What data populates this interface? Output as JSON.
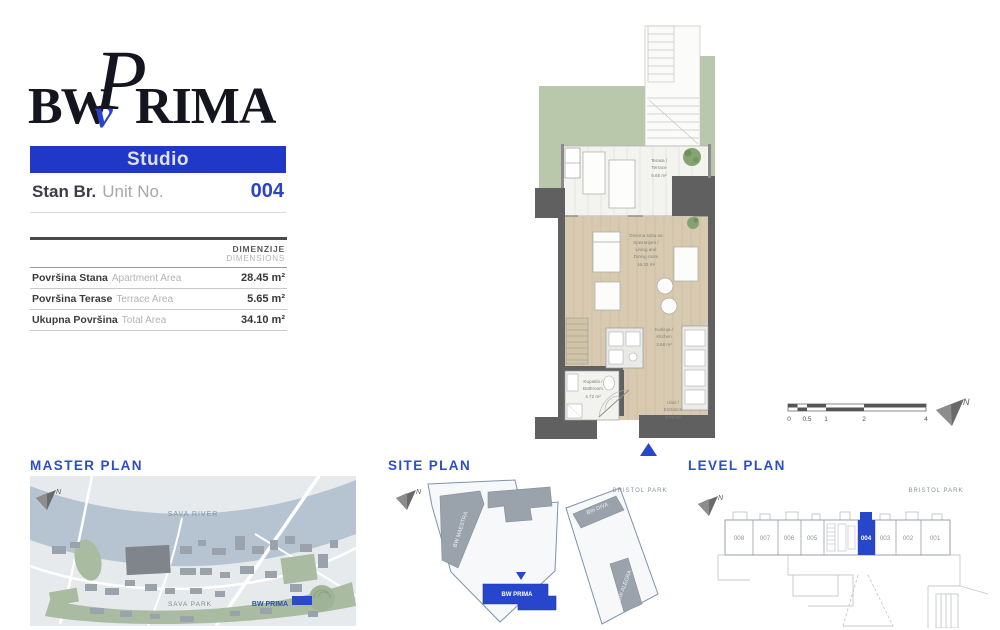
{
  "colors": {
    "accent_blue": "#2b43c8",
    "banner_blue": "#2038c8",
    "wall_gray": "#606060",
    "floor_wood": "#d8cab0",
    "lawn_green": "#b9c7ab",
    "river_blue": "#b6c3d1",
    "park_green": "#a9bca1",
    "building_gray": "#9aa2ab"
  },
  "logo": {
    "bw": "BW",
    "v": "v",
    "p": "P",
    "rima": "RIMA"
  },
  "unit_card": {
    "type_label": "Studio",
    "stan_br": "Stan Br.",
    "unit_no": "Unit No.",
    "unit_number": "004"
  },
  "dimensions_table": {
    "header_sr": "DIMENZIJE",
    "header_en": "DIMENSIONS",
    "rows": [
      {
        "label_sr": "Površina Stana",
        "label_en": "Apartment Area",
        "value": "28.45 m²"
      },
      {
        "label_sr": "Površina Terase",
        "label_en": "Terrace Area",
        "value": "5.65 m²"
      },
      {
        "label_sr": "Ukupna Površina",
        "label_en": "Total Area",
        "value": "34.10 m²"
      }
    ]
  },
  "floor_plan": {
    "rooms": {
      "terrace": {
        "lines": [
          "Terasa /",
          "Terrace",
          "5.65 m²"
        ]
      },
      "living": {
        "lines": [
          "Dnevna soba sa",
          "trpezarijom /",
          "Living and",
          "Dining room",
          "16.32 m²"
        ]
      },
      "kitchen": {
        "lines": [
          "Kuhinja /",
          "Kitchen",
          "3.68 m²"
        ]
      },
      "bathroom": {
        "lines": [
          "Kupatilo /",
          "Bathroom",
          "4.72 m²"
        ]
      },
      "entrance": {
        "lines": [
          "Ulaz /",
          "Entrance",
          "3.73 m²"
        ]
      }
    },
    "scale_bar_ticks": [
      "0",
      "0.5",
      "1",
      "2",
      "4"
    ],
    "north_label": "N"
  },
  "master_plan": {
    "title": "MASTER PLAN",
    "labels": {
      "river": "SAVA RIVER",
      "park": "SAVA PARK",
      "bw_prima": "BW PRIMA"
    }
  },
  "site_plan": {
    "title": "SITE PLAN",
    "labels": {
      "bristol_park": "BRISTOL PARK",
      "bw_maestra": "BW MAESTRA",
      "bw_diva": "BW DIVA",
      "bw_alegra": "BW ALEGRA",
      "bw_prima": "BW PRIMA"
    }
  },
  "level_plan": {
    "title": "LEVEL PLAN",
    "labels": {
      "bristol_park": "BRISTOL PARK"
    },
    "units": [
      "008",
      "007",
      "006",
      "005",
      "004",
      "003",
      "002",
      "001"
    ],
    "highlighted_unit": "004"
  }
}
